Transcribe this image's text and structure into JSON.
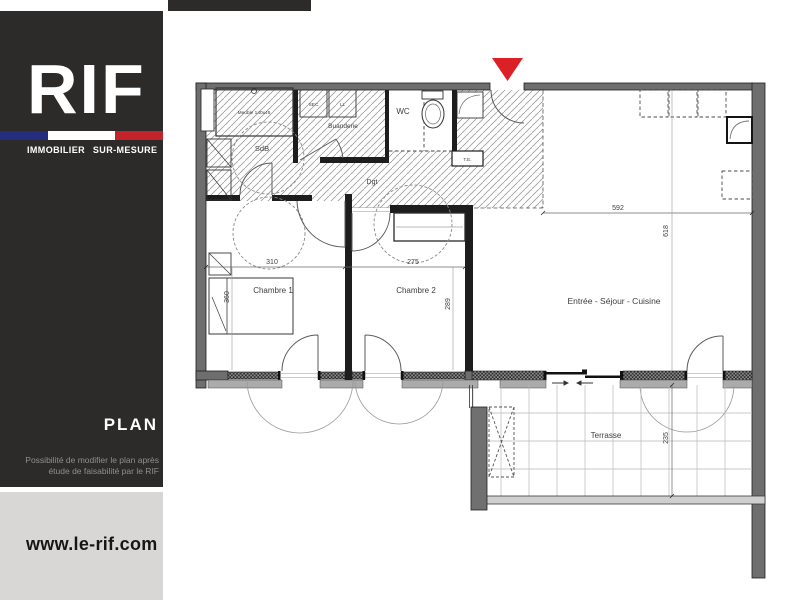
{
  "brand": {
    "logo": "RIF",
    "tagline": "IMMOBILIER SUR-MESURE",
    "section_title": "PLAN",
    "note_line1": "Possibilité de modifier le plan après",
    "note_line2": "étude de faisabilité par le RIF",
    "website": "www.le-rif.com"
  },
  "colors": {
    "sidebar_bg": "#2C2B2A",
    "footer_bg": "#D8D7D5",
    "flag_blue": "#232F7E",
    "flag_white": "#FFFFFF",
    "flag_red": "#C4232B",
    "entrance_marker_red": "#DB2026",
    "note_gray": "#8F8F8F",
    "wall_gray": "#6E6E6E"
  },
  "plan": {
    "rooms": {
      "sdb": "SdB",
      "buanderie": "Buanderie",
      "wc": "WC",
      "dgt": "Dgt",
      "chambre1": "Chambre 1",
      "chambre2": "Chambre 2",
      "sejour": "Entrée - Séjour - Cuisine",
      "terrasse": "Terrasse"
    },
    "fixtures": {
      "sec": "SEC",
      "ll": "LL",
      "te": "T.E.",
      "meuble": "Meuble 140x45"
    },
    "dimensions": {
      "sejour_width": "592",
      "sejour_height": "618",
      "chambre1_width": "310",
      "chambre1_height": "360",
      "chambre2_width": "275",
      "chambre2_height": "289",
      "terrasse_depth": "235"
    }
  }
}
